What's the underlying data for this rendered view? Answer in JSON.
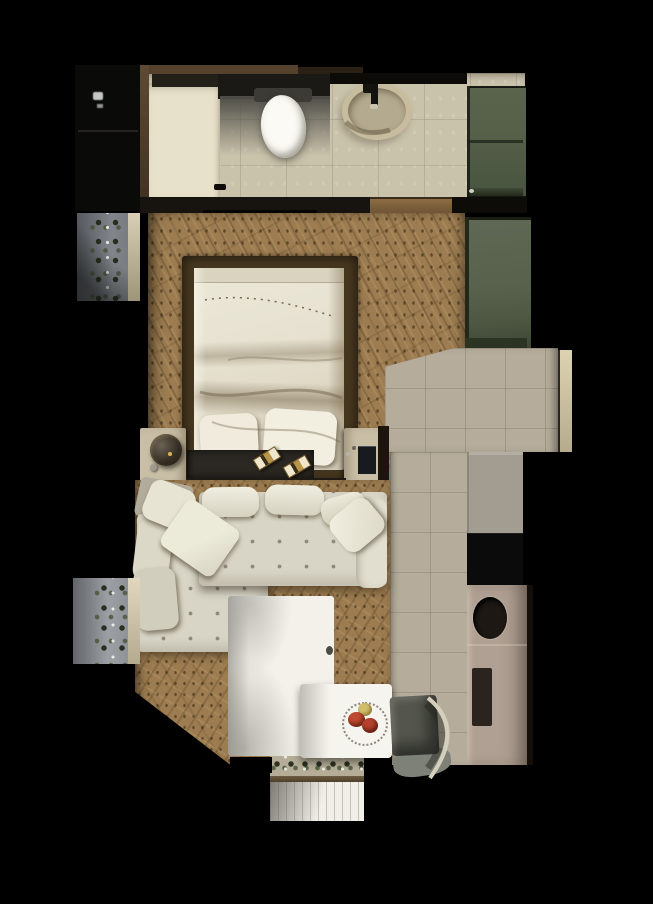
{
  "meta": {
    "title": "Studio apartment floor plan - top-down 3D render",
    "canvas_width": 653,
    "canvas_height": 904,
    "view": "orthographic top view, dark background"
  },
  "palette": {
    "background": "#000000",
    "entry_dark": "#0a0a09",
    "bathroom_tile": "#cac3ac",
    "bathroom_tile_bright": "#e7e1cb",
    "hall_tile": "#b5ac9b",
    "wood_floor": "#9c7c50",
    "wall_brown": "#54422c",
    "wall_beige": "#d6ccb2",
    "cabinet_green": "#57614a",
    "wardrobe_green": "#5a6450",
    "bed_frame_brown": "#46371f",
    "duvet_cream": "#e7e2d2",
    "pillow_white": "#f0ebdd",
    "headboard_dark": "#2b2722",
    "console_black": "#0c0c0c",
    "nightstand_beige": "#c9bfa6",
    "sofa_cream": "#d8d5c6",
    "sofa_cream_light": "#e1decf",
    "rug_white": "#f3f1e9",
    "table_white": "#f6f4ee",
    "chair_gray": "#54554d",
    "counter_upper_gray": "#a39c90",
    "counter_taupe": "#b0a093",
    "cooktop_black": "#0b0b0b",
    "sink_black": "#1d1814",
    "balcony_gray": "#8b8f94",
    "threshold_beige": "#b5ad97",
    "deck_white": "#f1efe7",
    "apple_red": "#b5402e",
    "apple_red2": "#c04a30",
    "apple_yellow": "#d1bf6c",
    "sconce_gold": "#c9b27a"
  },
  "rooms": {
    "entry": {
      "label": "entry closet",
      "floor": "dark",
      "furniture": [
        "dark-storage"
      ]
    },
    "bathroom": {
      "label": "bathroom",
      "floor": "beige ceramic tile",
      "furniture": [
        "shower-mat",
        "vanity-counter",
        "toilet",
        "round-basin",
        "faucet",
        "green-cabinet"
      ]
    },
    "bedroom": {
      "label": "bedroom",
      "floor": "herringbone wood",
      "furniture": [
        "platform-bed",
        "duvet",
        "pillow-left",
        "pillow-right",
        "headboard",
        "sconce-1",
        "sconce-2",
        "nightstand-left",
        "table-lamp",
        "nightstand-right",
        "green-wardrobe"
      ]
    },
    "living": {
      "label": "living / dining area",
      "floor": "herringbone wood",
      "furniture": [
        "sectional-sofa",
        "throw-pillows",
        "media-consoles",
        "rug",
        "dining-table",
        "fruit-bowl",
        "chair"
      ]
    },
    "kitchen": {
      "label": "kitchen / hallway",
      "floor": "gray tile",
      "furniture": [
        "counter-block",
        "cooktop",
        "round-sink",
        "cutting-board"
      ]
    },
    "balconies": {
      "label": "balconies",
      "items": [
        "balcony-upper-left",
        "balcony-lower-left",
        "balcony-bottom-deck",
        "planter-threshold"
      ]
    }
  }
}
